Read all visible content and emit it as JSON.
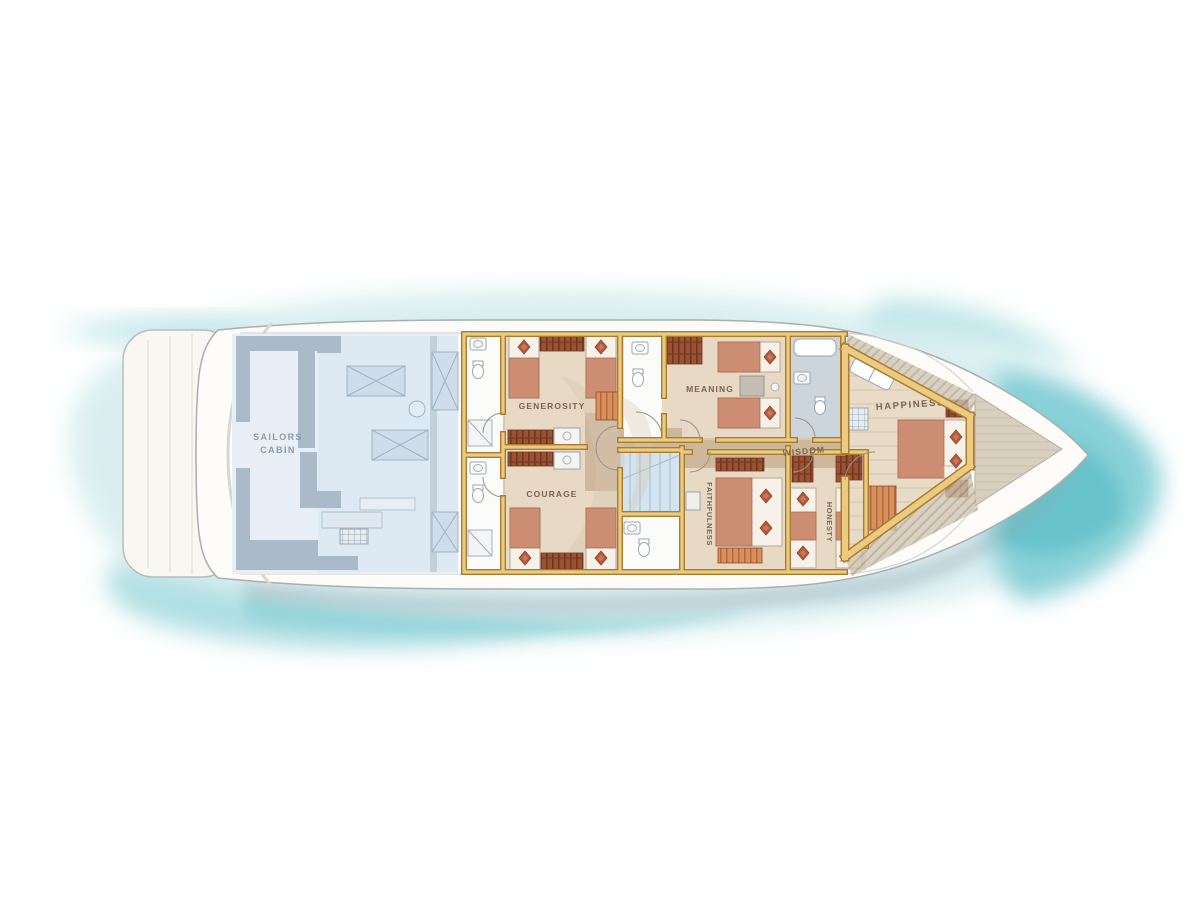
{
  "title": "Yacht lower deck floor plan",
  "labels": {
    "sailors_cabin_line1": "SAILORS",
    "sailors_cabin_line2": "CABIN",
    "generosity": "GENEROSITY",
    "courage": "COURAGE",
    "meaning": "MEANING",
    "faithfulness": "FAITHFULNESS",
    "wisdom": "WISDOM",
    "honesty": "HONESTY",
    "happiness": "HAPPINESS"
  },
  "colors": {
    "background": "#ffffff",
    "water_pale": "#d8eef0",
    "water_light": "#bce4e7",
    "water_band": "#a9dde1",
    "water_mid": "#7ecdd4",
    "water_deep": "#62c0ca",
    "water_streak": "#8fd3d8",
    "hull": "#fdfcf8",
    "hull_stroke": "#a9aeae",
    "platform": "#f8f7f1",
    "shadow": "#8fa5ad",
    "crew_floor": "#e7eef5",
    "crew_floor_inner": "#dce9f4",
    "crew_wall": "#abbac8",
    "crew_text": "#8d9dac",
    "guest_floor": "#d9c8af",
    "corridor": "#cdb89c",
    "cabin_floor": "#e7d9c4",
    "wall_gold": "#eccb7e",
    "wall_gold_dark": "#a87c34",
    "bath_floor": "#fbfbf9",
    "master_bath_floor": "#ccd4dc",
    "stairs": "#d3e4f0",
    "wood_dark": "#8a4a2e",
    "wood_mid": "#b06a3c",
    "wood_light": "#d9905c",
    "bed_blanket": "#cd8d72",
    "diamond": "#b55a3c",
    "label_text": "#7a6550",
    "master_floor": "#e9dcc6",
    "bow_deck": "#d9cfbf",
    "hatch": "#b3a58e",
    "watermark": "#d6c6ae"
  }
}
